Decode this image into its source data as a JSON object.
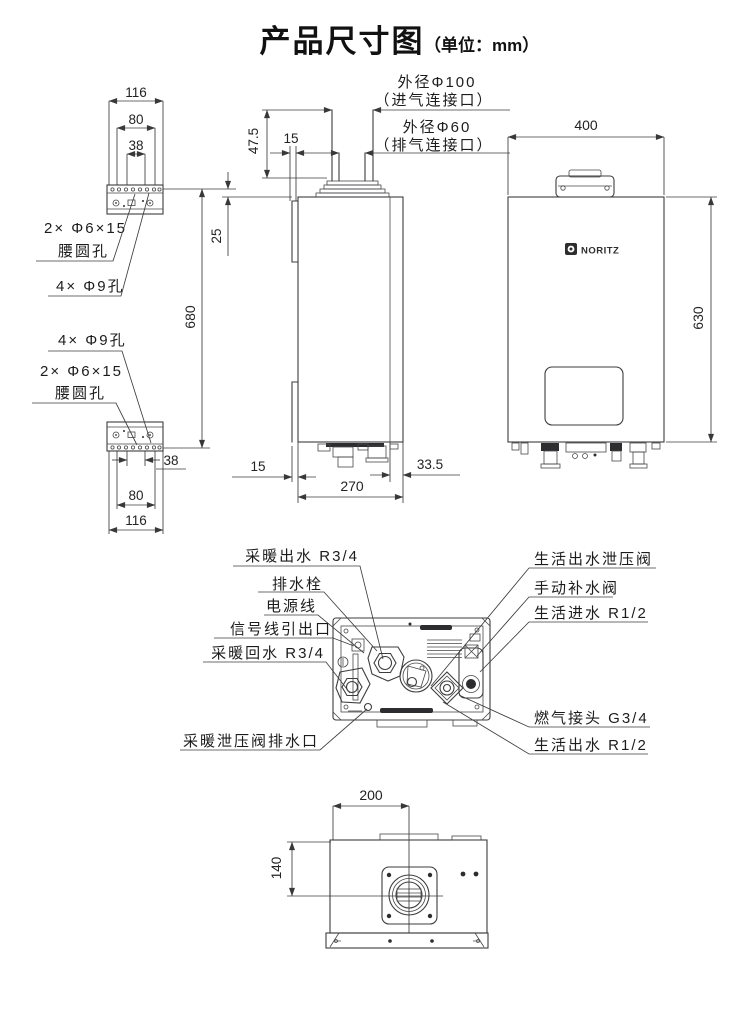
{
  "title": {
    "main": "产品尺寸图",
    "unit": "（单位：mm）"
  },
  "brand": {
    "logo_text": "NORITZ"
  },
  "callouts": {
    "intake_line1": "外径Φ100",
    "intake_line2": "（进气连接口）",
    "exhaust_line1": "外径Φ60",
    "exhaust_line2": "（排气连接口）"
  },
  "bracket_labels": {
    "slot_line1": "2× Φ6×15",
    "slot_line2": "腰圆孔",
    "holes": "4× Φ9孔"
  },
  "dims": {
    "bracket_outer": "116",
    "bracket_mid": "80",
    "bracket_inner": "38",
    "hole_top_offset": "25",
    "hole_span": "680",
    "collar_height": "47.5",
    "flue_side_offset": "15",
    "front_width": "400",
    "front_height": "630",
    "bottom_front_offset": "15",
    "depth": "270",
    "rear_rail_depth": "33.5",
    "flue_center_from_left": "200",
    "flue_center_from_front": "140"
  },
  "connections": {
    "left": [
      "采暖出水 R3/4",
      "排水栓",
      "电源线",
      "信号线引出口",
      "采暖回水 R3/4",
      "采暖泄压阀排水口"
    ],
    "right": [
      "生活出水泄压阀",
      "手动补水阀",
      "生活进水 R1/2",
      "燃气接头 G3/4",
      "生活出水 R1/2"
    ]
  },
  "colors": {
    "line": "#3d3d3f",
    "text": "#1c1c1c",
    "dark_fill": "#2d2d2f",
    "background": "#ffffff"
  }
}
